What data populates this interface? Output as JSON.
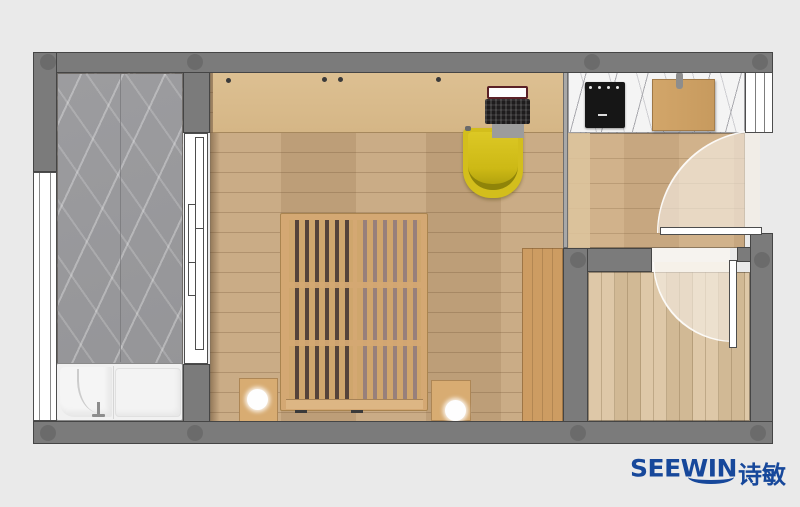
{
  "brand": {
    "name_en": "SEEWIN",
    "name_zh": "诗敏"
  },
  "palette": {
    "background": "#eaeaea",
    "wall": "#7b7b7b",
    "wall_outline": "#454545",
    "column": "#696969",
    "bath_marble": "#9c9c9f",
    "slab_seam": "#6f6f73",
    "window_white": "#ffffff",
    "bedroom_floor": "#c7a77e",
    "desk_wood": "#ddc092",
    "kitchen_floor": "#cfae85",
    "kitchen_strip": "#ddc49e",
    "counter_marble": "#f4f4f4",
    "marble_vein": "#a9a9ae",
    "small_room_floor": "#d8bf9a",
    "doorway_floor": "#f6f3ef",
    "bed_wood": "#d4a873",
    "bed_slat": "#cfa66d",
    "bed_gap_dark": "#55433a",
    "bed_gap_soft": "#97807b",
    "bed_rail": "#ddb684",
    "wardrobe_wood": "#cd9c62",
    "nightstand_wood": "#d8ac72",
    "lamp_white": "#fefefe",
    "chair_yellow": "#d3be1c",
    "chair_dark": "#8f8409",
    "laptop_black": "#1e1c1d",
    "laptop_frame": "#5a2026",
    "laptop_gray": "#9c9c9c",
    "cooktop_black": "#161616",
    "board_wood": "#d2a66a",
    "handle_gray": "#8d8d8d",
    "tub_white": "#f1f1f1",
    "tub_line": "#cccccc",
    "swing_fill": "rgba(246,239,229,0.62)",
    "brand": "#17489b"
  }
}
